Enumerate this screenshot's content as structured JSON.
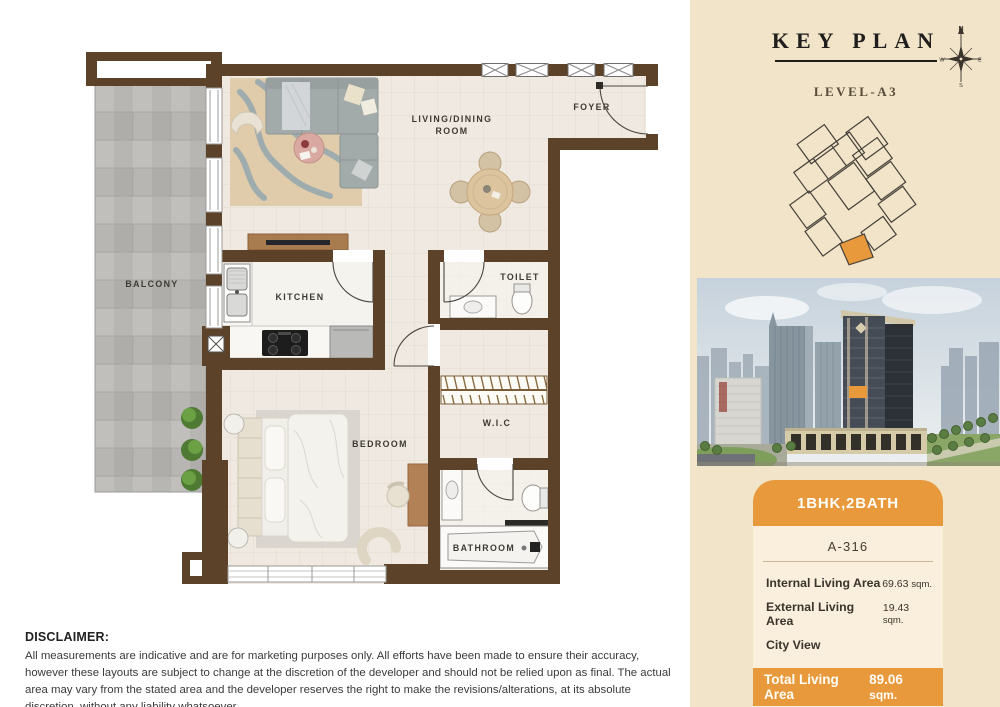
{
  "floor_plan": {
    "rooms": {
      "balcony": "BALCONY",
      "living_dining_line1": "LIVING/DINING",
      "living_dining_line2": "ROOM",
      "foyer": "FOYER",
      "kitchen": "KITCHEN",
      "toilet": "TOILET",
      "wic": "W.I.C",
      "bedroom": "BEDROOM",
      "bathroom": "BATHROOM"
    }
  },
  "key_plan": {
    "title": "KEY PLAN",
    "level": "LEVEL-A3",
    "compass": {
      "north": "N",
      "east": "E",
      "south": "S",
      "west": "W"
    }
  },
  "unit_card": {
    "type": "1BHK,2BATH",
    "unit_number": "A-316",
    "rows": [
      {
        "label": "Internal Living Area",
        "value": "69.63",
        "unit": "sqm."
      },
      {
        "label": "External Living Area",
        "value": "19.43",
        "unit": "sqm."
      },
      {
        "label": "City View",
        "value": "",
        "unit": ""
      }
    ],
    "total": {
      "label": "Total Living Area",
      "value": "89.06",
      "unit": "sqm."
    }
  },
  "disclaimer": {
    "heading": "DISCLAIMER:",
    "body": "All measurements are indicative and are for marketing purposes only. All efforts have been made to ensure their accuracy, however these layouts are subject to change at the discretion of the developer and should not be relied upon as final. The actual area may vary from the stated area and the developer reserves the right to make the revisions/alterations, at its absolute discretion, without any liability whatsoever"
  },
  "colors": {
    "accent_orange": "#e8993b",
    "wall_brown": "#5b4228",
    "panel_cream": "#f2e4c9"
  }
}
